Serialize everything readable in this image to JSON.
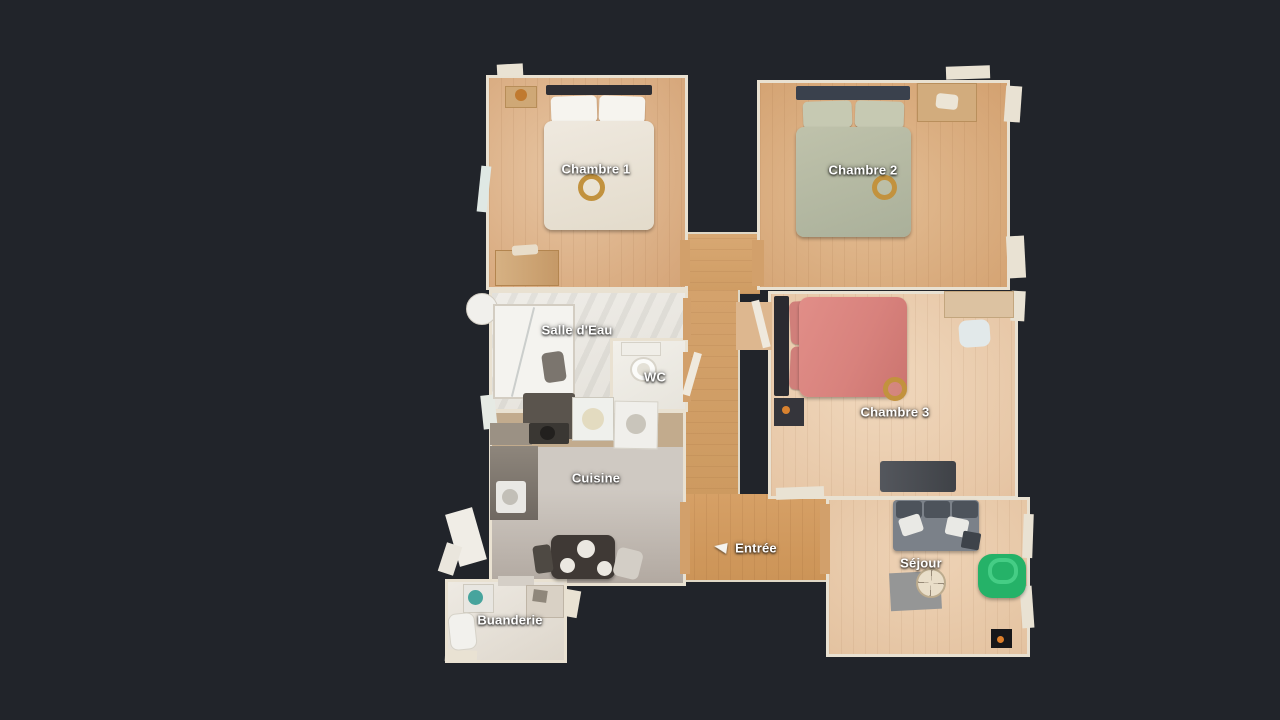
{
  "labels": {
    "chambre1": "Chambre 1",
    "chambre2": "Chambre 2",
    "chambre3": "Chambre 3",
    "salle_deau": "Salle d'Eau",
    "wc": "WC",
    "cuisine": "Cuisine",
    "entree": "Entrée",
    "sejour": "Séjour",
    "buanderie": "Buanderie"
  },
  "icons": {
    "entree_marker": "door-swing-icon"
  },
  "colors": {
    "bg": "#21242a",
    "wall": "#e9e1d1",
    "wood_warm": "#d2a06b",
    "wood_light": "#d7a87c",
    "wood_pale": "#e6c5a4",
    "tile": "#eceae4",
    "kitchen_floor": "#c0b8b0",
    "laundry_floor": "#ebe7e0",
    "label_text": "#ffffff",
    "bed_chambre1": "#efe9df",
    "bed_chambre2": "#bfc2ab",
    "bed_chambre3": "#d8827d",
    "sofa_gray": "#7b8189",
    "pouf_green": "#25b268",
    "gold": "#c2923e"
  }
}
